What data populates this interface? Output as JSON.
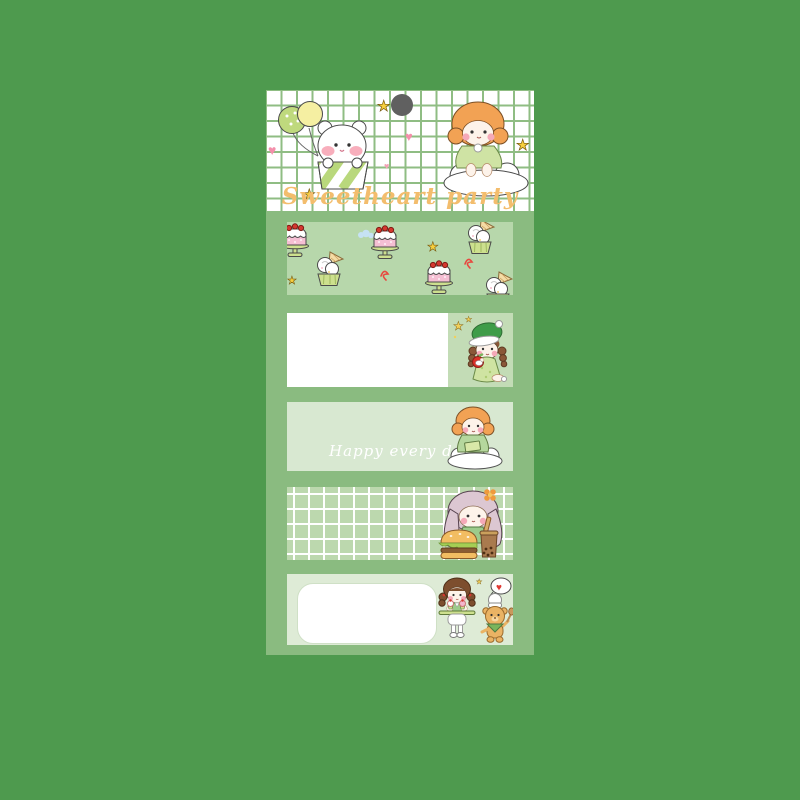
{
  "header": {
    "title": "Sweetheart party",
    "icons": [
      "balloons-icon",
      "bear-in-giftbox-icon",
      "girl-on-cloud-icon",
      "heart-icon",
      "star-icon",
      "punch-dot-icon"
    ]
  },
  "strips": [
    {
      "name": "cake-pattern-strip",
      "icons": [
        "cake-icon",
        "cupcake-icon",
        "star-icon",
        "squiggle-icon",
        "mini-cloud-icon"
      ]
    },
    {
      "name": "white-label-strip",
      "icons": [
        "girl-with-apple-icon",
        "star-icon"
      ]
    },
    {
      "name": "happy-strip",
      "text": "Happy every day",
      "icons": [
        "girl-reading-on-cloud-icon"
      ]
    },
    {
      "name": "grid-strip",
      "icons": [
        "girl-with-burger-icon"
      ]
    },
    {
      "name": "rounded-label-strip",
      "icons": [
        "baker-girl-icon",
        "chef-bear-icon",
        "heart-bubble-icon",
        "star-icon"
      ]
    }
  ],
  "colors": {
    "background": "#4e9a4e",
    "panel": "#8abb80",
    "header_bg": "#ffffff",
    "header_grid_line": "#8fbd83",
    "title_text": "#f3bd6d",
    "strip1_bg": "#b7d7ab",
    "strip2_left_bg": "#ffffff",
    "strip2_right_bg": "#c3dcb6",
    "strip3_bg": "#d8e8d1",
    "strip3_text": "#ffffff",
    "strip4_bg": "#bcd8ae",
    "strip4_grid_line": "#ffffff",
    "strip5_bg": "#deebd6",
    "strip5_label_bg": "#ffffff",
    "punch_dot": "#606060",
    "accent_heart_pink": "#f48fab",
    "accent_star_yellow": "#f7cf3e"
  }
}
